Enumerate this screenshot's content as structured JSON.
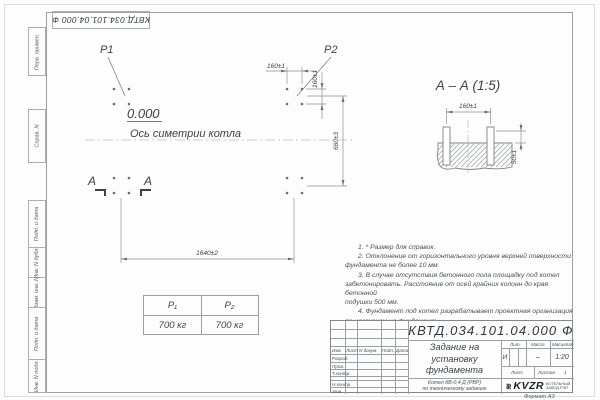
{
  "doc_number": "КВТД.034.101.04.000  Ф",
  "margin_boxes": [
    "Перв. примен.",
    "Справ. N",
    "Подп. и дата",
    "Инв. N дубл.",
    "Взам. инв. N",
    "Подп. и дата",
    "Инв. N подл."
  ],
  "plan": {
    "p1_label": "P1",
    "p2_label": "P2",
    "elevation": "0.000",
    "axis_label": "Ось симетрии котла",
    "dim_spacing_h": "160±1",
    "dim_spacing_v": "160±1",
    "dim_width": "660±3",
    "dim_length": "1640±2",
    "section_letter_left": "А",
    "section_letter_right": "А"
  },
  "section_view": {
    "title": "А – А (1:5)",
    "dim_spacing": "160±1",
    "dim_height": "50±1"
  },
  "load_table": {
    "headers": [
      "P₁",
      "P₂"
    ],
    "values": [
      "700 кг",
      "700 кг"
    ]
  },
  "notes": [
    "1. * Размер для справок.",
    "2. Отклонение от горизонтального уровня верхней поверхности",
    "фундамента не более 10 мм.",
    "3. В случае отсутствия бетонного пола площадку под котел",
    "забетонировать. Расстояние от осей крайних колонн до края бетонной",
    "подушки 500 мм.",
    "4. Фундамент под котел разрабатывает проектная организация",
    "по нагрузкам на фундамент."
  ],
  "title_block": {
    "header_cols": [
      "Изм.",
      "Лист",
      "N докум.",
      "Подп.",
      "Дата"
    ],
    "row_labels": [
      "Разраб.",
      "Пров.",
      "Т.контр.",
      "Н.контр.",
      "Утв."
    ],
    "title_lines": [
      "Задание на",
      "установку",
      "фундамента"
    ],
    "subject_lines": [
      "Котел  КВ-0,4  Д  (РВР)",
      "по техническому заданию"
    ],
    "lit_label": "Лит.",
    "lit_value": "И",
    "mass_label": "Масса",
    "mass_value": "–",
    "scale_label": "Масштаб",
    "scale_value": "1:20",
    "sheet_label": "Лист",
    "sheets_label": "Листов",
    "sheets_value": "1",
    "logo_text": "KVZR",
    "logo_caption": [
      "КОТЕЛЬНЫЙ",
      "ЗАВОД РЭП"
    ],
    "format_note": "Формат А3"
  }
}
